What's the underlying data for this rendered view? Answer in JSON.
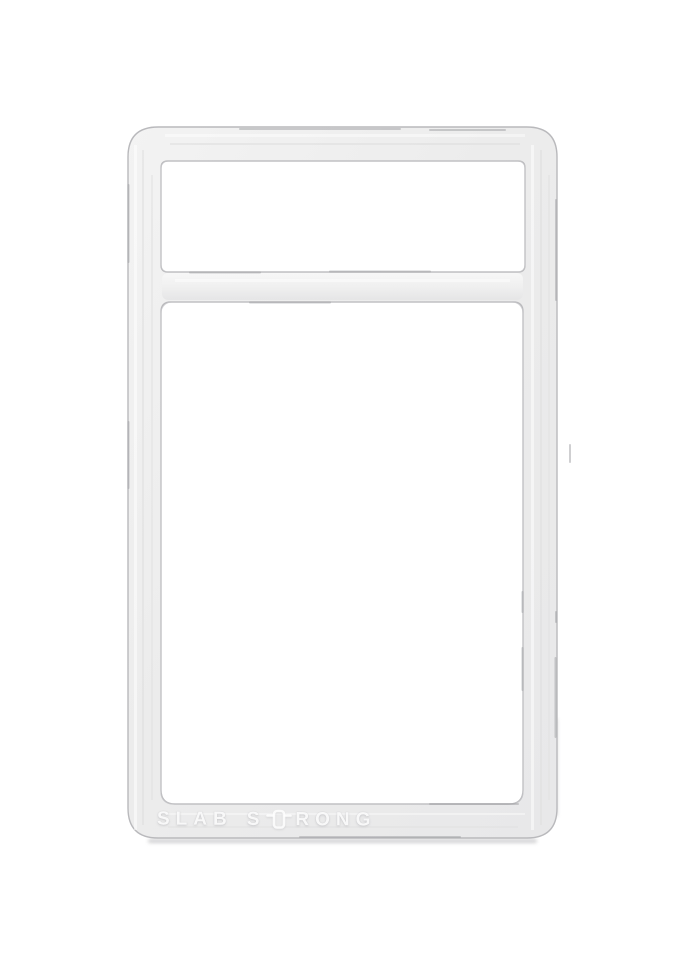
{
  "scene": {
    "description": "Empty translucent white plastic card-slab frame photographed on a plain white background",
    "background_color": "#ffffff"
  },
  "frame": {
    "fill_color": "#ededed",
    "edge_color": "#b9b9bc",
    "highlight_color": "#f8f8f8",
    "shadow_color": "#c2c2c4"
  },
  "branding": {
    "full_text": "SLAB STRONG",
    "word1": "SLAB",
    "word2_prefix": "S",
    "word2_suffix": "RONG",
    "icon": "slab-logo-icon",
    "text_color": "#f6f6f6"
  }
}
